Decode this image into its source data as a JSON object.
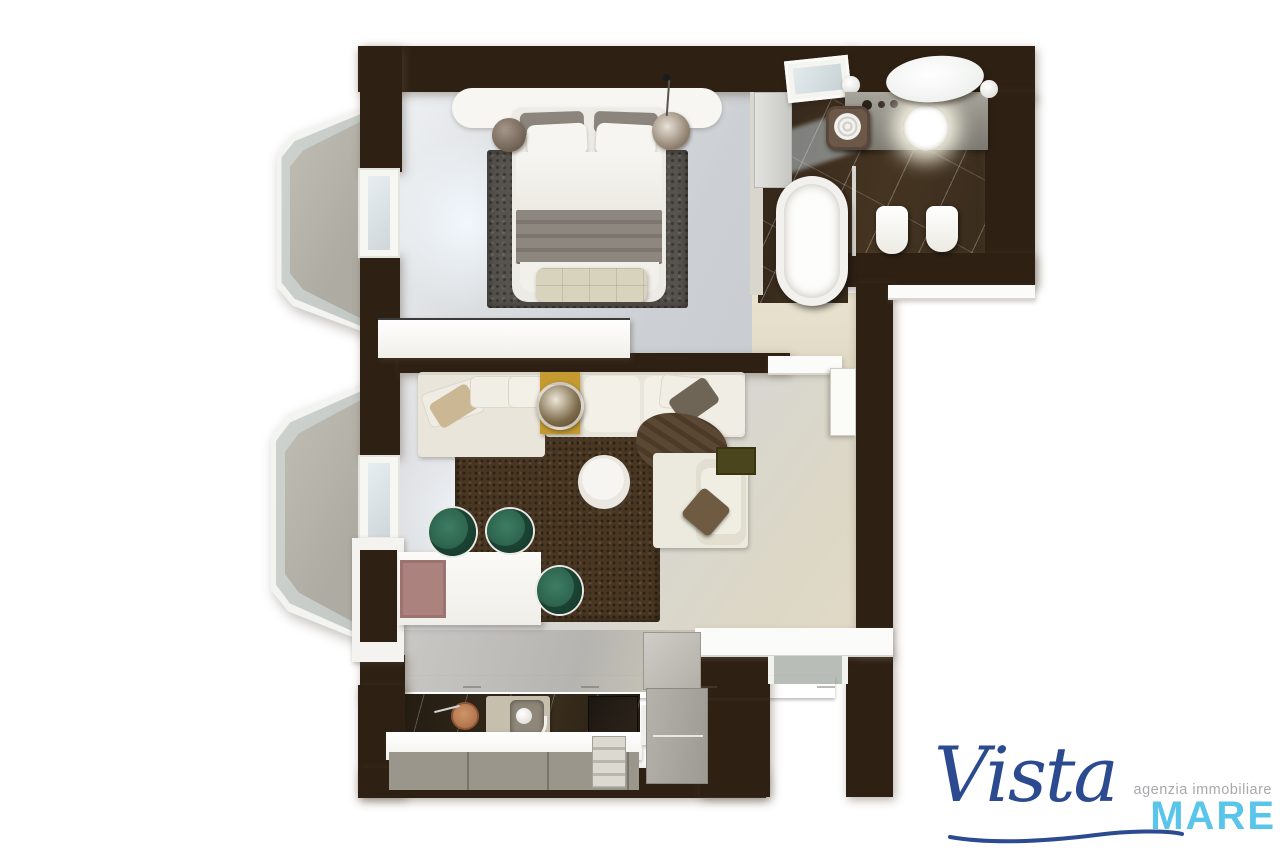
{
  "logo": {
    "name_script": "Vista",
    "name_caps": "MARE",
    "tagline": "agenzia immobiliare",
    "colors": {
      "script": "#2b4a8f",
      "caps": "#59c5ea",
      "tagline": "#a7a9ac"
    }
  },
  "palette": {
    "wall": "#2e2114",
    "bedroom-floor": "#d6d9dc",
    "living-floor": "#d8d8d6",
    "hall-floor": "#e4decb",
    "bathroom-floor": "#38291c",
    "balcony-floor": "#b2afa6",
    "bedroom-rug": "#56524d",
    "living-rug": "#4a3722",
    "sofa": "#eae6dc",
    "accent-table": "#c59b31",
    "dining-chair": "#2f6a52",
    "ottoman": "#4b451d",
    "tray": "#ab827e",
    "counter-marble": "#241c12",
    "cabinet-front": "#9b968c",
    "steel": "#aca89f"
  }
}
